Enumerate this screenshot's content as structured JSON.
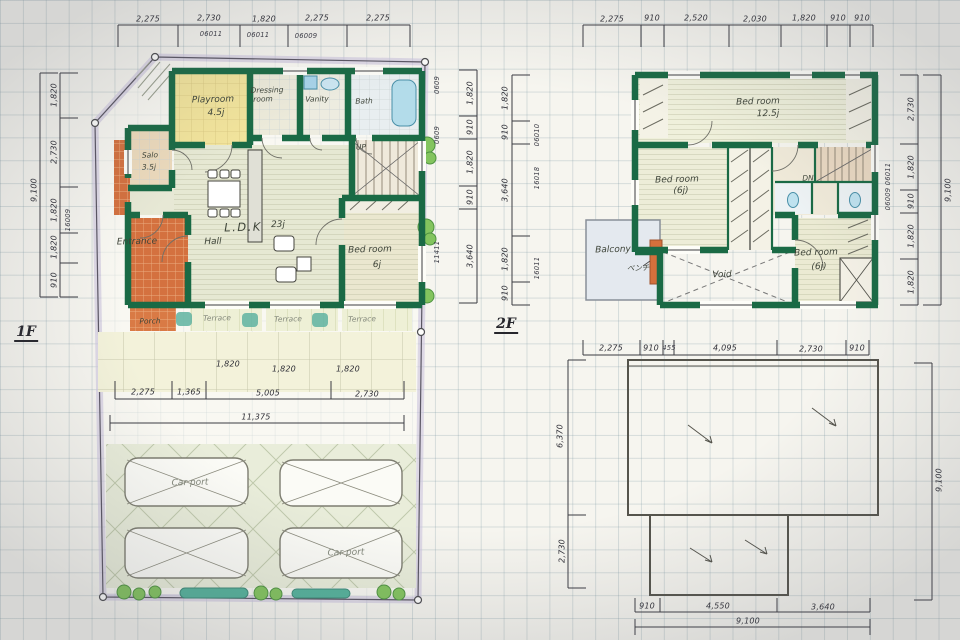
{
  "f1": {
    "floor_label": "1F",
    "top_dims": [
      "2,275",
      "2,730",
      "1,820",
      "2,275",
      "2,275"
    ],
    "top_codes": [
      "06011",
      "06011",
      "06009"
    ],
    "left_total": "9,100",
    "left_dims": [
      "1,820",
      "2,730",
      "1,820",
      "1,820",
      "910"
    ],
    "left_code": "16009",
    "right_codes": [
      "0609",
      "0609",
      "11411"
    ],
    "right_dims": [
      "1,820",
      "910",
      "1,820",
      "910",
      "3,640"
    ],
    "terrace_tile_dims": [
      "1,820",
      "1,820",
      "1,820"
    ],
    "bottom_dims": [
      "2,275",
      "1,365",
      "5,005",
      "2,730"
    ],
    "bottom_total": "11,375",
    "rooms": {
      "playroom": {
        "name": "Playroom",
        "size": "4.5j"
      },
      "dressing": {
        "line1": "Dressing",
        "line2": "room"
      },
      "vanity": "Vanity",
      "bath": "Bath",
      "salo": {
        "name": "Salo",
        "size": "3.5j"
      },
      "entrance": "Entrance",
      "hall": "Hall",
      "porch": "Porch",
      "ldk": {
        "name": "L.D.K",
        "size": "23j"
      },
      "bedroom": {
        "name": "Bed room",
        "size": "6j"
      },
      "stairs": "UP",
      "terraces": [
        "Terrace",
        "Terrace",
        "Terrace"
      ]
    },
    "carport_labels": [
      "Car port",
      "Car port"
    ]
  },
  "f2": {
    "floor_label": "2F",
    "top_dims": [
      "2,275",
      "910",
      "2,520",
      "2,030",
      "1,820",
      "910",
      "910"
    ],
    "left_dims": [
      "1,820",
      "910",
      "3,640",
      "1,820",
      "910"
    ],
    "left_codes": [
      "06010",
      "16018",
      "16011"
    ],
    "right_total": "9,100",
    "right_dims": [
      "2,730",
      "1,820",
      "910",
      "1,820",
      "1,820"
    ],
    "right_codes": [
      "06011",
      "06009"
    ],
    "bottom_dims": [
      "2,275",
      "910",
      "455",
      "4,095",
      "2,730",
      "910"
    ],
    "rooms": {
      "bedroom_main": {
        "name": "Bed room",
        "size": "12.5j"
      },
      "bedroom_left": {
        "name": "Bed room",
        "size": "(6j)"
      },
      "bedroom_right": {
        "name": "Bed room",
        "size": "(6j)"
      },
      "balcony": "Balcony",
      "balcony_note": "ベンチ",
      "void": "Void",
      "stairs": "DN"
    }
  },
  "roof": {
    "left_dims": [
      "6,370",
      "2,730"
    ],
    "right_total": "9,100",
    "bottom_dims": [
      "910",
      "4,550",
      "3,640"
    ],
    "bottom_total": "9,100"
  }
}
